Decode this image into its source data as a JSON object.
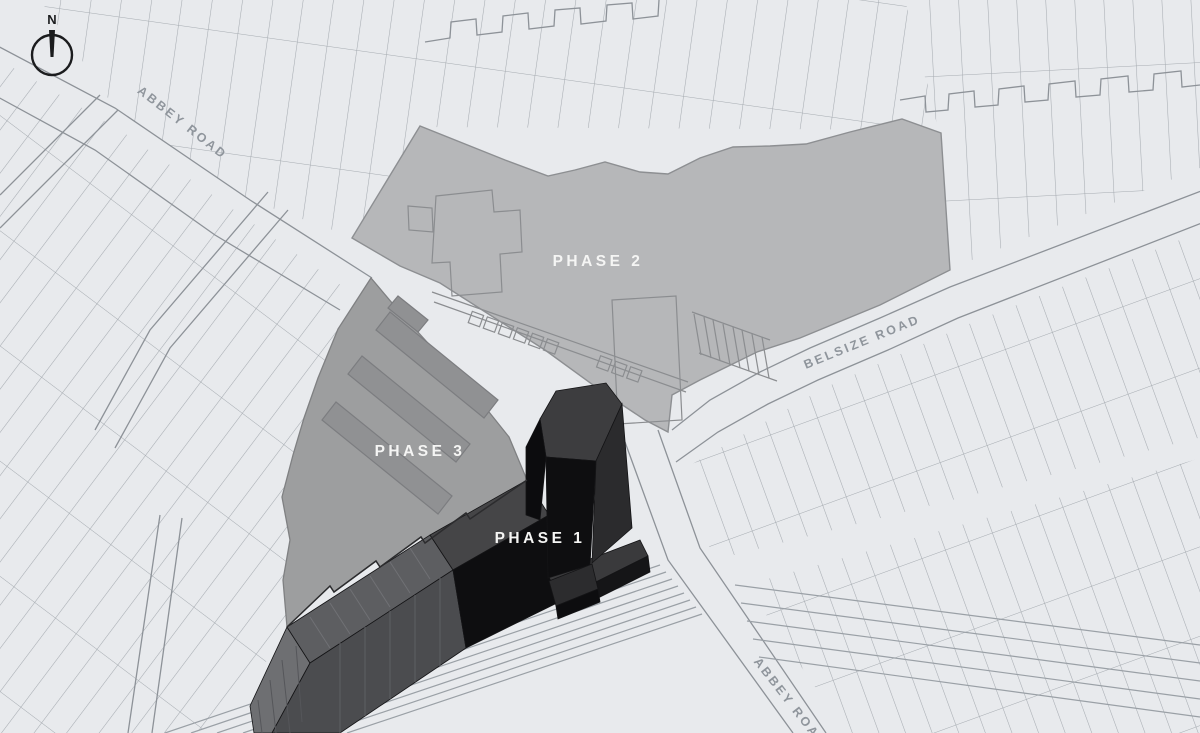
{
  "map": {
    "compass": {
      "label": "N"
    },
    "road_labels": [
      {
        "id": "abbey-road-northwest",
        "text": "ABBEY ROAD"
      },
      {
        "id": "belsize-road",
        "text": "BELSIZE ROAD"
      },
      {
        "id": "abbey-road-southeast",
        "text": "ABBEY ROAD"
      }
    ],
    "phases": [
      {
        "id": "phase-1",
        "name": "PHASE 1"
      },
      {
        "id": "phase-2",
        "name": "PHASE 2"
      },
      {
        "id": "phase-3",
        "name": "PHASE 3"
      }
    ],
    "colors": {
      "background": "#e8eaed",
      "map_line": "#989da3",
      "phase2_fill": "#b6b7b9",
      "phase2_line": "#8d8f92",
      "phase3_fill": "#9d9e9f",
      "phase3_line": "#7f8082",
      "phase3_slab": "#909193",
      "roof_gray": "#5d5e61",
      "roof_dark": "#454547",
      "front_gray": "#4b4c4f",
      "building_black": "#0e0e10",
      "tower_top": "#3d3d3f",
      "tower_side": "#2b2b2d",
      "plinth_gray": "#3a3a3c",
      "label_white": "#f5f5f4",
      "road_label_color": "#8f959c",
      "compass_color": "#1b1c1e"
    }
  }
}
